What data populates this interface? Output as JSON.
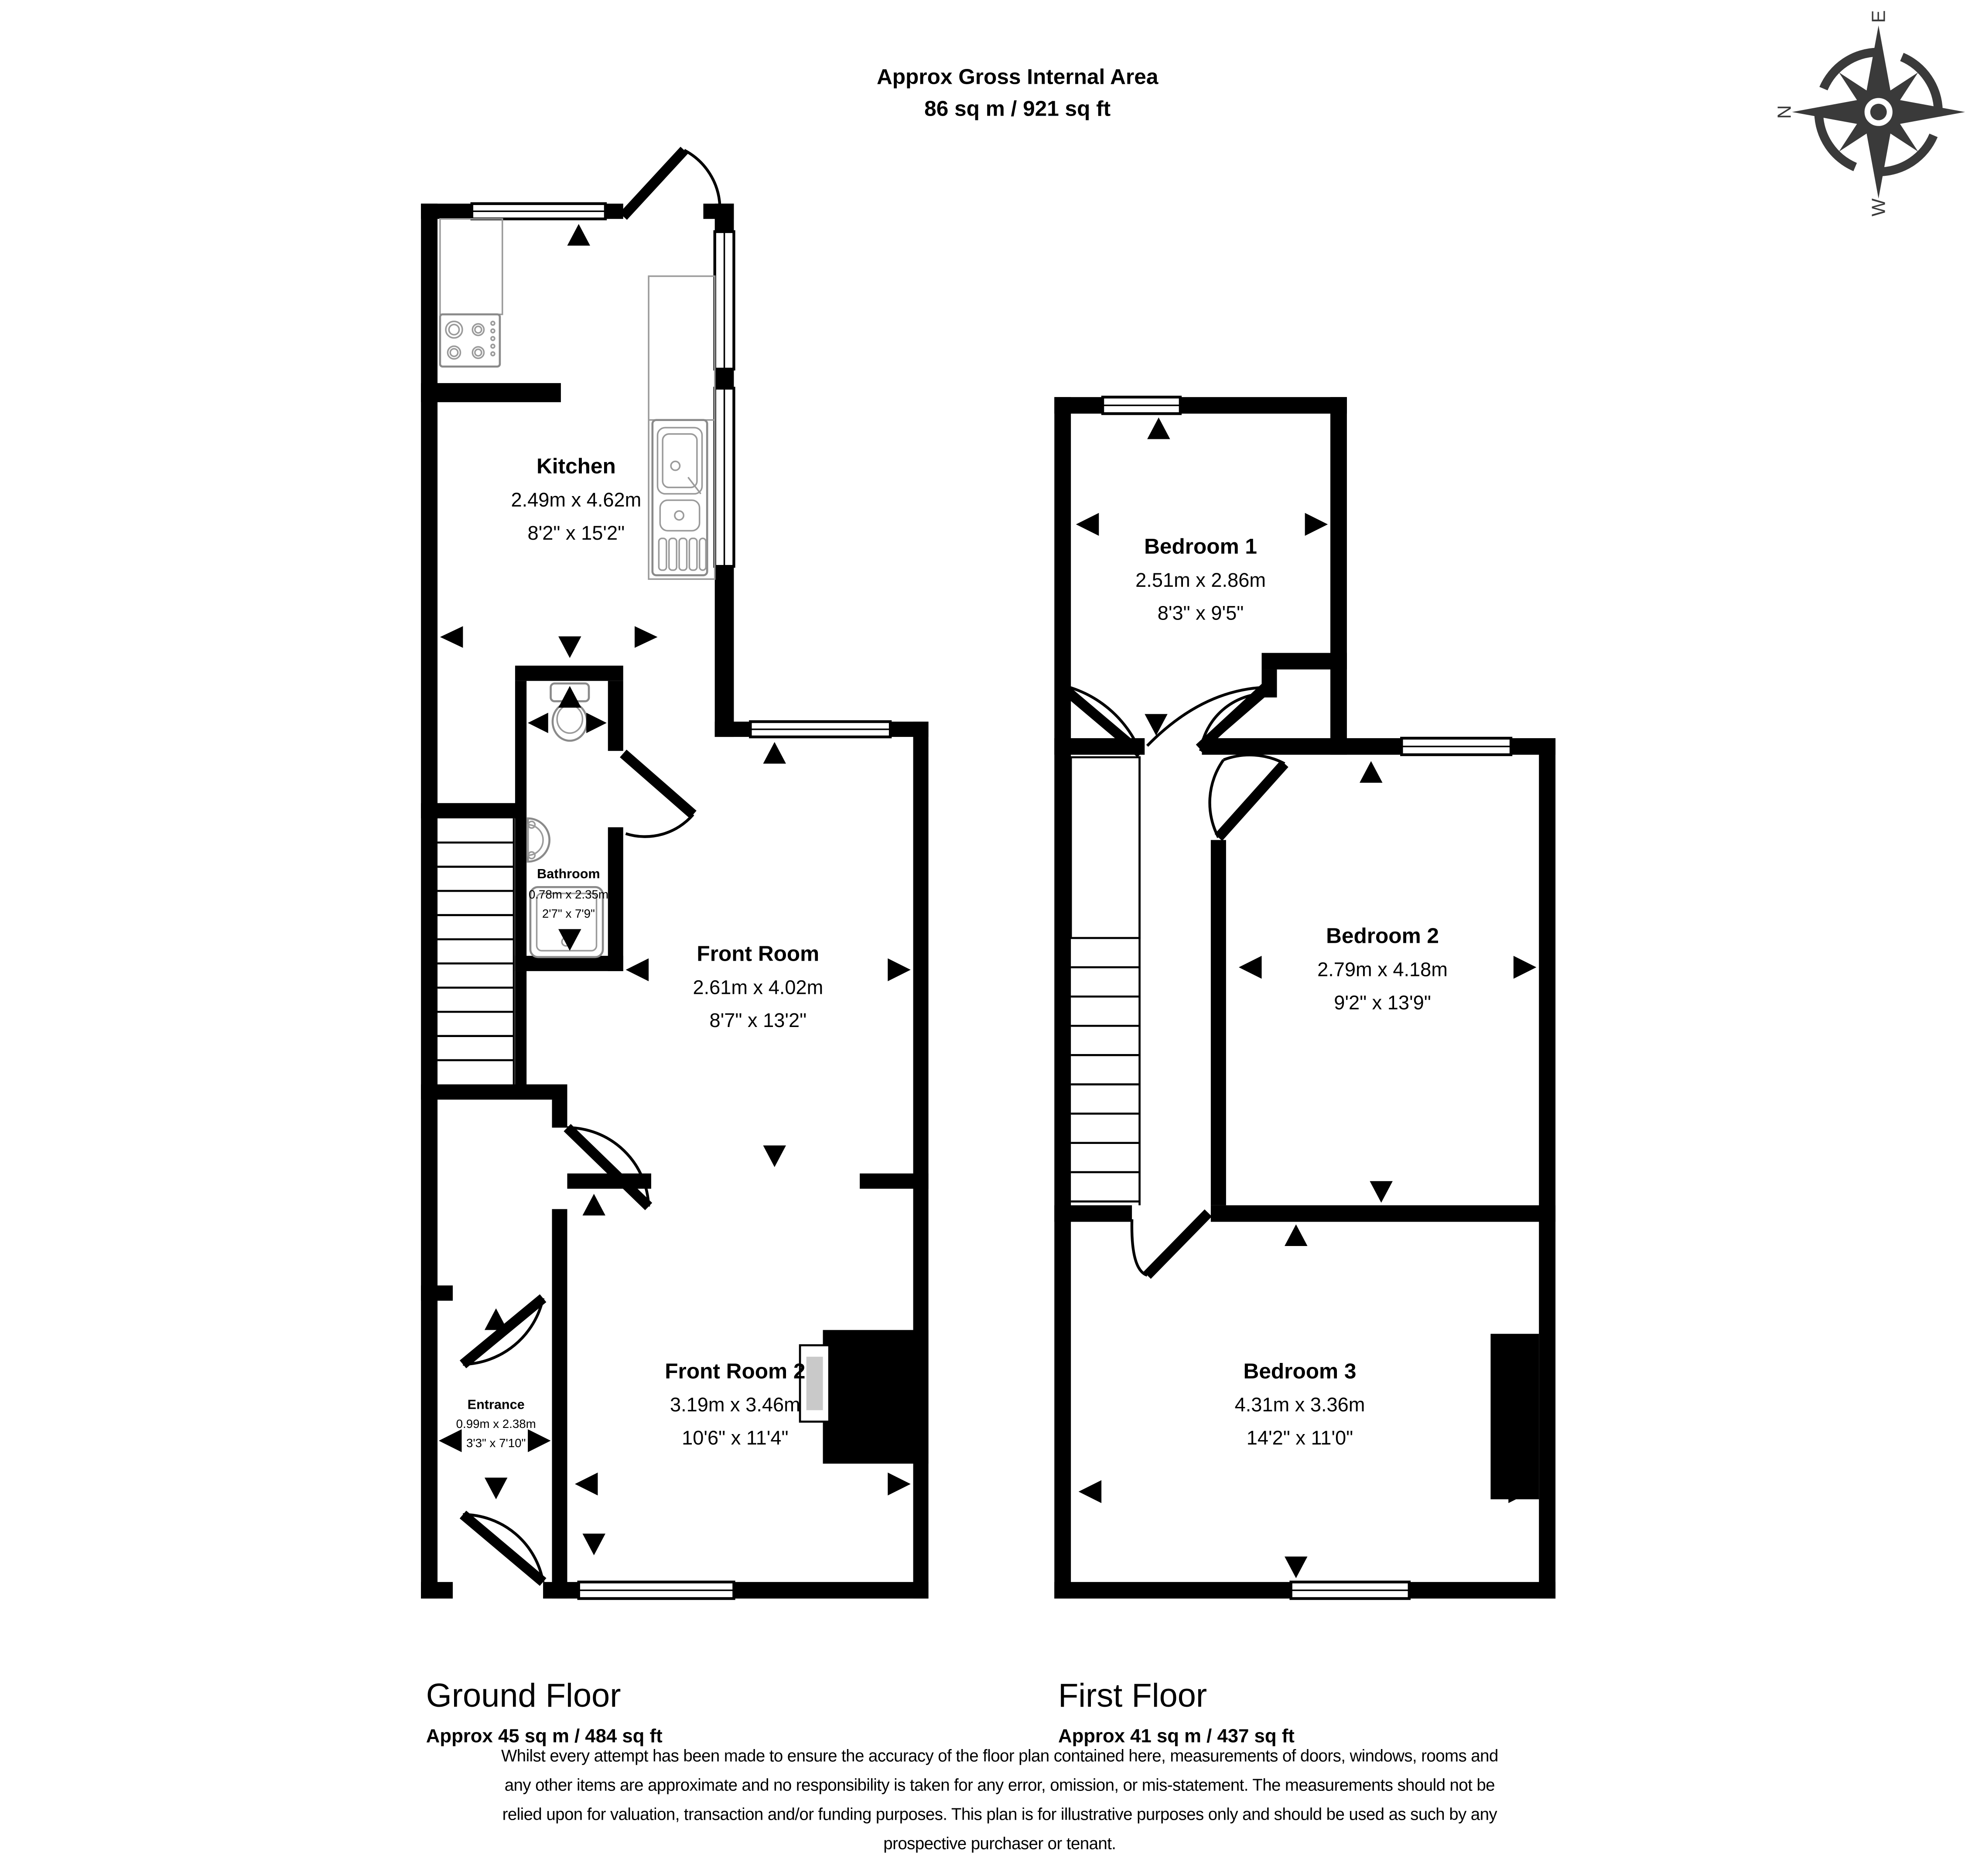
{
  "header": {
    "title": "Approx Gross Internal Area",
    "subtitle": "86 sq m / 921 sq ft"
  },
  "compass": {
    "n": "N",
    "e": "E",
    "s": "S",
    "w": "W"
  },
  "floors": [
    {
      "label": "Ground Floor",
      "area": "Approx 45 sq m / 484 sq ft",
      "rooms": [
        {
          "name": "Kitchen",
          "metric": "2.49m x 4.62m",
          "imperial": "8'2\" x 15'2\""
        },
        {
          "name": "Bathroom",
          "metric": "0.78m x 2.35m",
          "imperial": "2'7\" x 7'9\""
        },
        {
          "name": "Front Room",
          "metric": "2.61m x 4.02m",
          "imperial": "8'7\" x 13'2\""
        },
        {
          "name": "Front Room 2",
          "metric": "3.19m x 3.46m",
          "imperial": "10'6\" x 11'4\""
        },
        {
          "name": "Entrance",
          "metric": "0.99m x 2.38m",
          "imperial": "3'3\" x 7'10\""
        }
      ]
    },
    {
      "label": "First Floor",
      "area": "Approx 41 sq m / 437 sq ft",
      "rooms": [
        {
          "name": "Bedroom 1",
          "metric": "2.51m x 2.86m",
          "imperial": "8'3\" x 9'5\""
        },
        {
          "name": "Bedroom 2",
          "metric": "2.79m x 4.18m",
          "imperial": "9'2\" x 13'9\""
        },
        {
          "name": "Bedroom 3",
          "metric": "4.31m x 3.36m",
          "imperial": "14'2\" x 11'0\""
        }
      ]
    }
  ],
  "disclaimer": {
    "line1": "Whilst every attempt has been made to ensure the accuracy of the floor plan contained here, measurements of doors, windows, rooms and",
    "line2": "any other items are approximate and no responsibility is taken for any error, omission, or mis-statement. The measurements should not be",
    "line3": "relied upon for valuation, transaction and/or funding purposes. This plan is for illustrative purposes only and should be used as such by any",
    "line4": "prospective purchaser or tenant."
  }
}
